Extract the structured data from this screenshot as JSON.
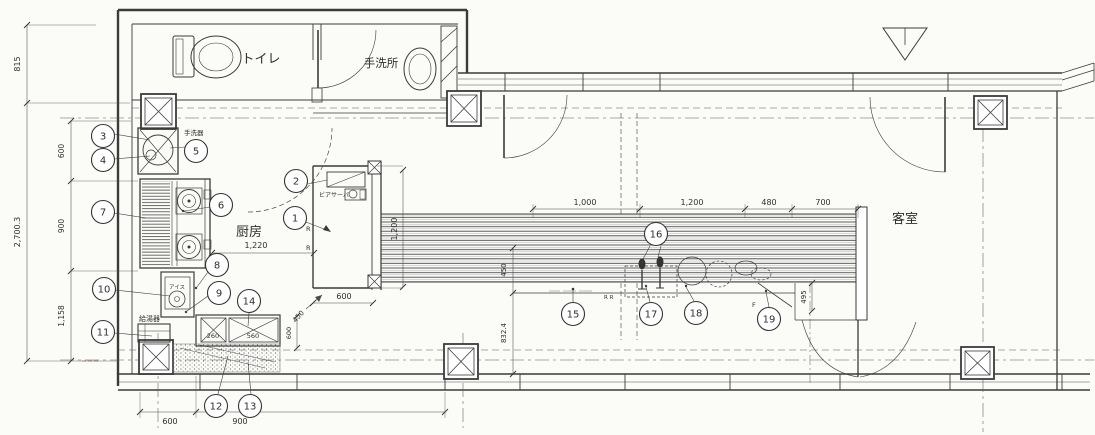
{
  "drawing": {
    "rooms": {
      "toilet": "トイレ",
      "washroom": "手洗所",
      "kitchen": "厨房",
      "guest_room": "客室"
    },
    "labels": {
      "hand_wash_basin": "手洗器",
      "water_heater": "給湯器",
      "ice_maker": "アイス",
      "beer_server": "ビアサーバ",
      "door_r1": "R",
      "door_r2": "R",
      "counter_rr": "R R",
      "counter_f": "F"
    },
    "callouts": [
      "1",
      "2",
      "3",
      "4",
      "5",
      "6",
      "7",
      "8",
      "9",
      "10",
      "11",
      "12",
      "13",
      "14",
      "15",
      "16",
      "17",
      "18",
      "19"
    ],
    "dimensions": {
      "left_815": "815",
      "left_total": "2,700.3",
      "left_600": "600",
      "left_900": "900",
      "left_1158": "1,158",
      "bottom_600": "600",
      "bottom_900": "900",
      "kitchen_1220": "1,220",
      "beer_600": "600",
      "beer_1200": "1,200",
      "pass_450": "450",
      "sink_260": "260",
      "sink_560": "560",
      "sink_600": "600",
      "counter_1000": "1,000",
      "counter_1200": "1,200",
      "counter_480": "480",
      "counter_700": "700",
      "counter_450": "450",
      "counter_495": "495",
      "counter_8324": "832.4"
    }
  }
}
